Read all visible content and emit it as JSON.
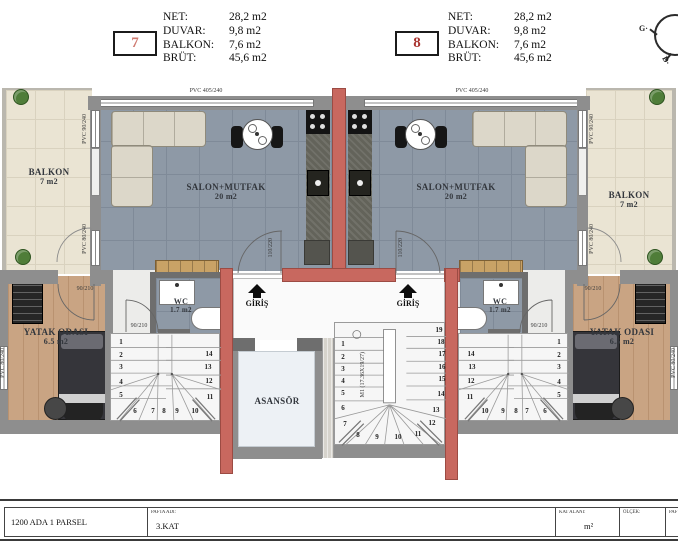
{
  "header": {
    "units": [
      {
        "number": "7",
        "rows": [
          [
            "NET:",
            "28,2 m2"
          ],
          [
            "DUVAR:",
            "9,8 m2"
          ],
          [
            "BALKON:",
            "7,6 m2"
          ],
          [
            "BRÜT:",
            "45,6 m2"
          ]
        ]
      },
      {
        "number": "8",
        "rows": [
          [
            "NET:",
            "28,2 m2"
          ],
          [
            "DUVAR:",
            "9,8 m2"
          ],
          [
            "BALKON:",
            "7,6 m2"
          ],
          [
            "BRÜT:",
            "45,6 m2"
          ]
        ]
      }
    ],
    "compass": {
      "g_label": "G·",
      "d_label": "D·"
    }
  },
  "rooms": {
    "balkon_left": {
      "name": "BALKON",
      "area": "7 m2"
    },
    "balkon_right": {
      "name": "BALKON",
      "area": "7 m2"
    },
    "salon_left": {
      "name": "SALON+MUTFAK",
      "area": "20 m2"
    },
    "salon_right": {
      "name": "SALON+MUTFAK",
      "area": "20 m2"
    },
    "wc_left": {
      "name": "WC",
      "area": "1.7 m2"
    },
    "wc_right": {
      "name": "WC",
      "area": "1.7 m2"
    },
    "bedroom_left": {
      "name": "YATAK ODASI",
      "area": "6.5 m2"
    },
    "bedroom_right": {
      "name": "YATAK ODASI",
      "area": "6.5 m2"
    },
    "elevator": {
      "name": "ASANSÖR"
    },
    "entrance_left": {
      "name": "GİRİŞ"
    },
    "entrance_right": {
      "name": "GİRİŞ"
    }
  },
  "plan_labels": {
    "window_top": "PVC 405/240",
    "window_90": "PVC 90/240",
    "window_80": "PVC 80/240",
    "door_bedroom": "90/210",
    "door_entry": "110/220",
    "stair_note": "M1 (17.36X19/27)"
  },
  "stairs": {
    "left_unit": [
      {
        "n": "1",
        "x": 10,
        "y": 8
      },
      {
        "n": "2",
        "x": 10,
        "y": 21
      },
      {
        "n": "3",
        "x": 10,
        "y": 33
      },
      {
        "n": "4",
        "x": 10,
        "y": 48
      },
      {
        "n": "5",
        "x": 10,
        "y": 61
      },
      {
        "n": "6",
        "x": 24,
        "y": 77
      },
      {
        "n": "7",
        "x": 42,
        "y": 77
      },
      {
        "n": "8",
        "x": 53,
        "y": 77
      },
      {
        "n": "9",
        "x": 66,
        "y": 77
      },
      {
        "n": "10",
        "x": 84,
        "y": 77
      },
      {
        "n": "11",
        "x": 99,
        "y": 63
      },
      {
        "n": "12",
        "x": 98,
        "y": 47
      },
      {
        "n": "13",
        "x": 97,
        "y": 33
      },
      {
        "n": "14",
        "x": 98,
        "y": 20
      }
    ],
    "right_unit": [
      {
        "n": "1",
        "x": 100,
        "y": 8
      },
      {
        "n": "2",
        "x": 100,
        "y": 21
      },
      {
        "n": "3",
        "x": 100,
        "y": 33
      },
      {
        "n": "4",
        "x": 100,
        "y": 48
      },
      {
        "n": "5",
        "x": 100,
        "y": 61
      },
      {
        "n": "6",
        "x": 86,
        "y": 77
      },
      {
        "n": "7",
        "x": 68,
        "y": 77
      },
      {
        "n": "8",
        "x": 57,
        "y": 77
      },
      {
        "n": "9",
        "x": 44,
        "y": 77
      },
      {
        "n": "10",
        "x": 26,
        "y": 77
      },
      {
        "n": "11",
        "x": 11,
        "y": 63
      },
      {
        "n": "12",
        "x": 12,
        "y": 47
      },
      {
        "n": "13",
        "x": 13,
        "y": 33
      },
      {
        "n": "14",
        "x": 12,
        "y": 20
      }
    ],
    "core": [
      {
        "n": "1",
        "x": 8,
        "y": 21
      },
      {
        "n": "2",
        "x": 8,
        "y": 34
      },
      {
        "n": "3",
        "x": 8,
        "y": 46
      },
      {
        "n": "4",
        "x": 8,
        "y": 58
      },
      {
        "n": "5",
        "x": 8,
        "y": 70
      },
      {
        "n": "6",
        "x": 8,
        "y": 85
      },
      {
        "n": "7",
        "x": 10,
        "y": 101
      },
      {
        "n": "8",
        "x": 23,
        "y": 112
      },
      {
        "n": "9",
        "x": 42,
        "y": 114
      },
      {
        "n": "10",
        "x": 63,
        "y": 114
      },
      {
        "n": "11",
        "x": 83,
        "y": 111
      },
      {
        "n": "12",
        "x": 97,
        "y": 100
      },
      {
        "n": "13",
        "x": 101,
        "y": 87
      },
      {
        "n": "14",
        "x": 106,
        "y": 71
      },
      {
        "n": "15",
        "x": 107,
        "y": 56
      },
      {
        "n": "16",
        "x": 107,
        "y": 44
      },
      {
        "n": "17",
        "x": 107,
        "y": 31
      },
      {
        "n": "18",
        "x": 106,
        "y": 19
      },
      {
        "n": "19",
        "x": 104,
        "y": 7
      }
    ]
  },
  "title_block": {
    "ada_parsel": "1200 ADA 1 PARSEL",
    "pafta_adi_label": "PAFTA ADI:",
    "pafta_adi_value": "3.KAT",
    "kat_alani_label": "KAT ALANI:",
    "kat_alani_value": "m²",
    "olcek_label": "ÖLÇEK:",
    "pafta_label": "PAF"
  },
  "colors": {
    "red_wall": "#c8685f",
    "unit7_number": "#cf7a70",
    "unit8_number": "#a93430",
    "salon_floor": "#8e99a6",
    "balcony_floor": "#eae4d3",
    "bedroom_floor": "#c9a483"
  }
}
